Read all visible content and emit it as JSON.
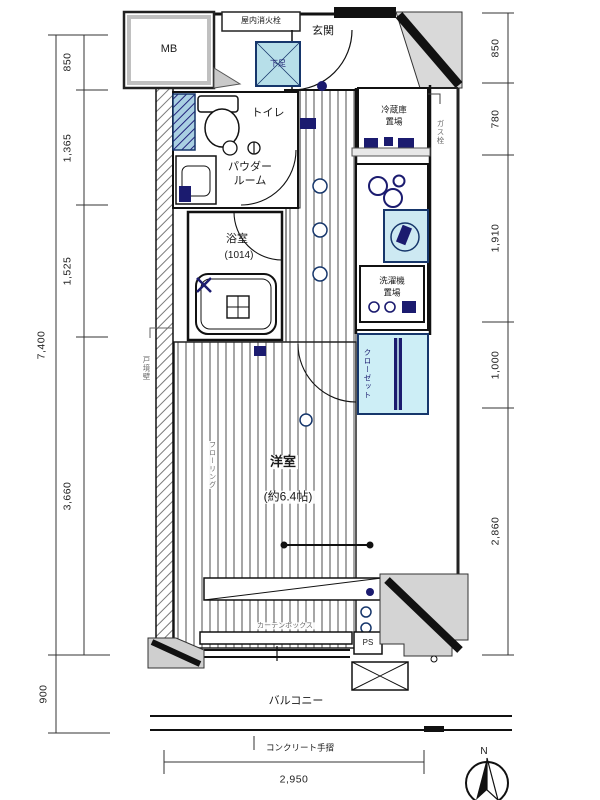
{
  "plan": {
    "rooms": {
      "entrance": "玄関",
      "toilet": "トイレ",
      "powder_line1": "パウダー",
      "powder_line2": "ルーム",
      "bath": "浴室",
      "bath_size": "(1014)",
      "western_room": "洋室",
      "western_room_size": "(約6.4帖)",
      "closet": "クローゼット",
      "balcony": "バルコニー"
    },
    "fixtures": {
      "meter_box": "MB",
      "fire_hydrant": "屋内消火栓",
      "shoe_box": "下足",
      "fridge_line1": "冷蔵庫",
      "fridge_line2": "置場",
      "washer_line1": "洗濯機",
      "washer_line2": "置場",
      "gas_valve": "ガス栓",
      "pipe_space": "PS",
      "flooring": "フローリング",
      "curtain_box": "カーテンボックス",
      "boundary_wall": "戸境壁",
      "handrail": "コンクリート手摺"
    },
    "dimensions": {
      "left_segments": [
        "850",
        "1,365",
        "1,525",
        "3,660"
      ],
      "left_total": "7,400",
      "balcony_depth": "900",
      "right_segments": [
        "850",
        "780",
        "1,910",
        "1,000",
        "2,860"
      ],
      "bottom_width": "2,950"
    },
    "compass": {
      "north": "N"
    },
    "colors": {
      "line": "#1a1a1a",
      "fixture_blue": "#1b1b6f",
      "light_blue": "#cdeef6",
      "wall_grey": "#d4d4d4"
    }
  }
}
